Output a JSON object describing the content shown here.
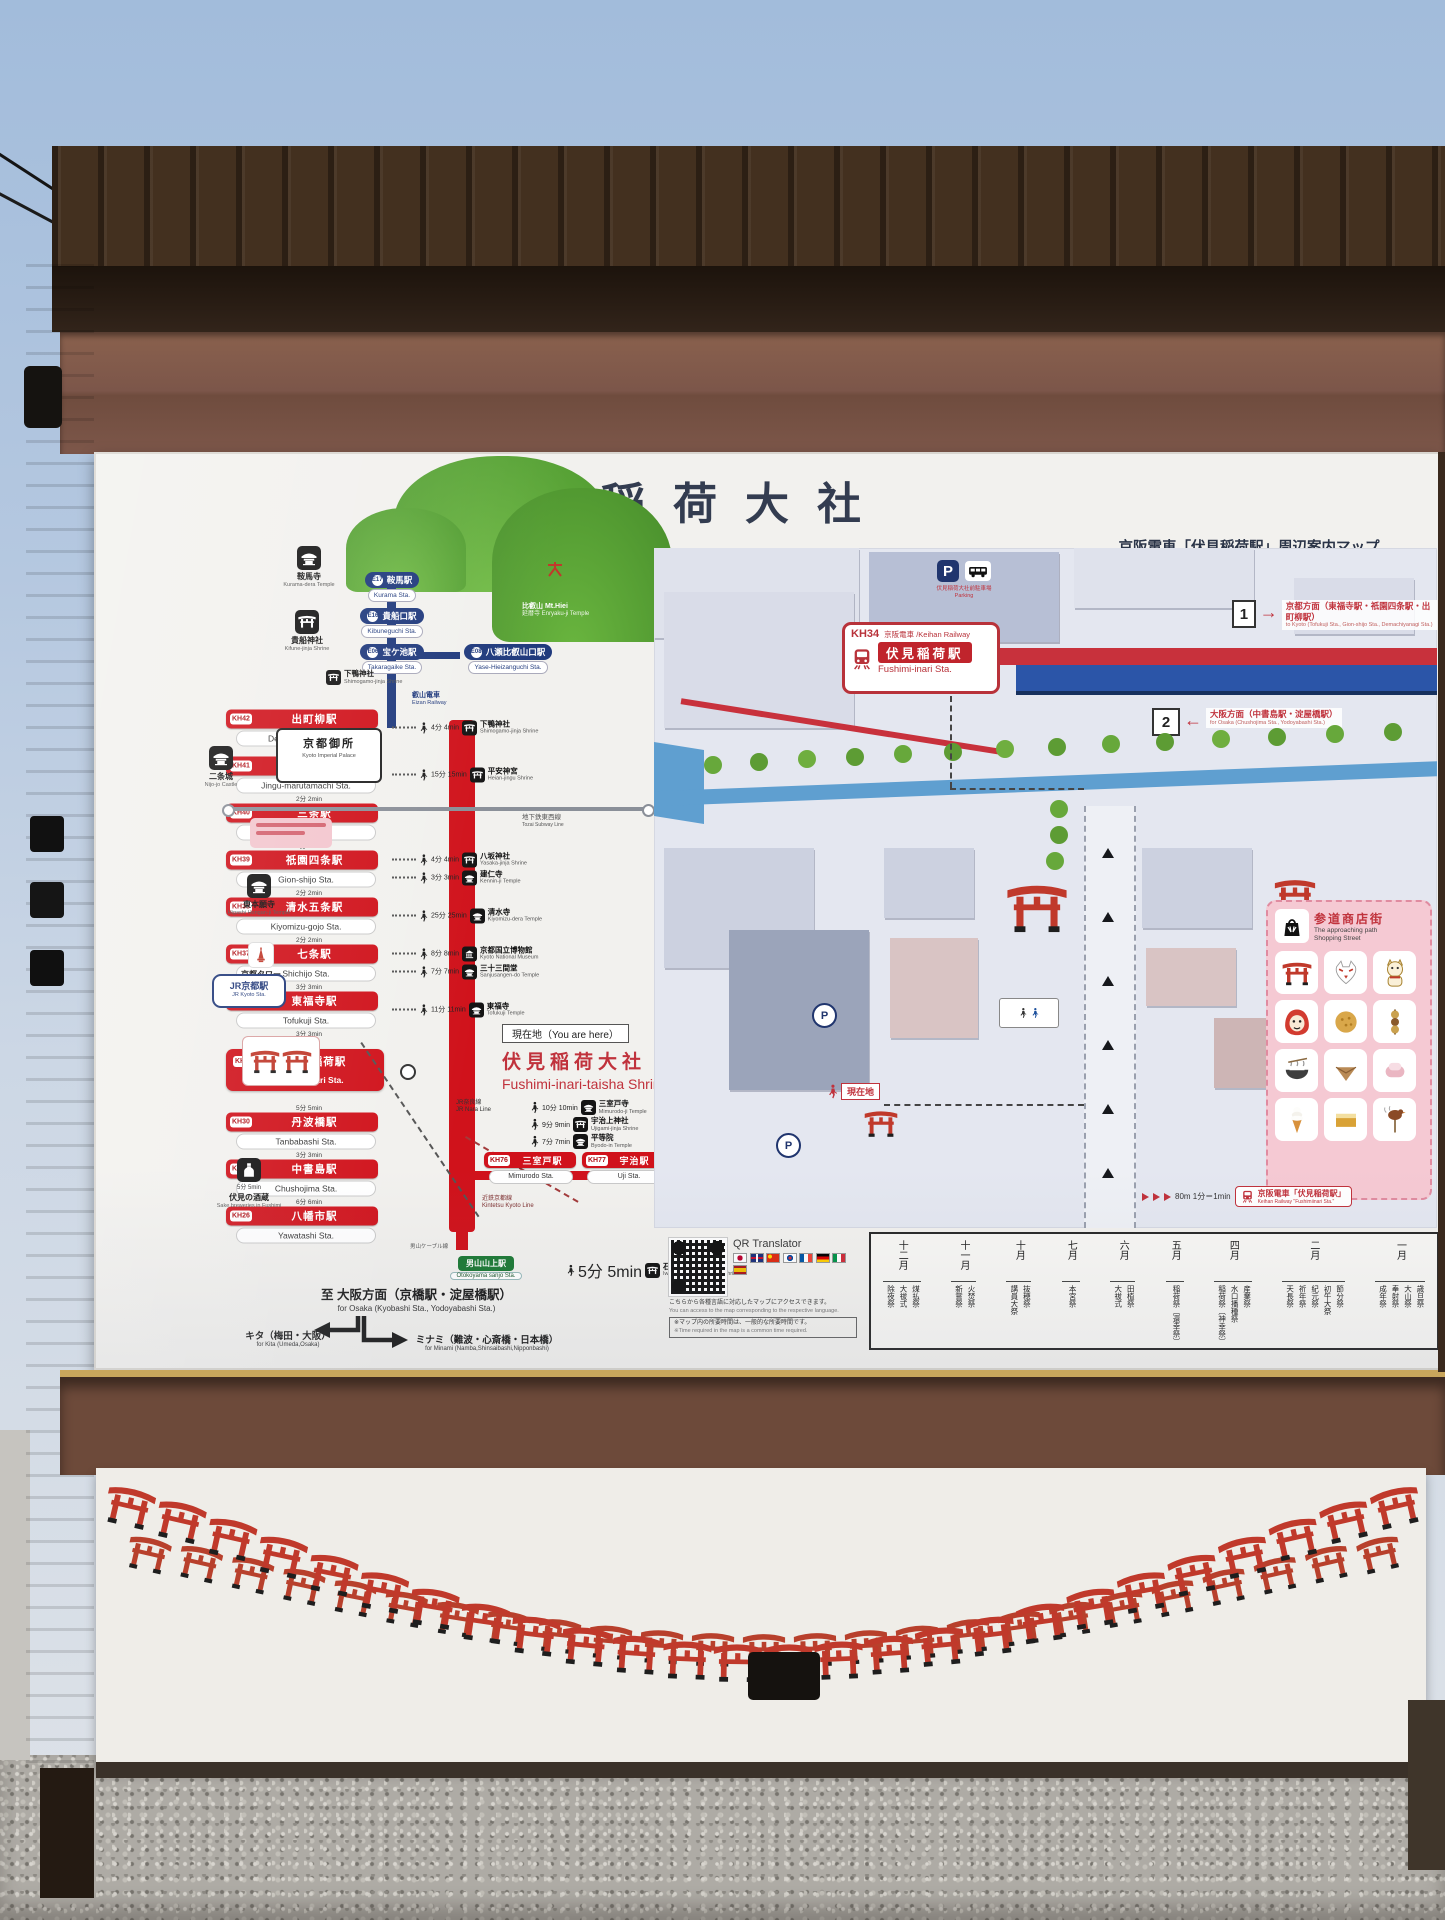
{
  "sign": {
    "title": "伏見稲荷大社"
  },
  "tourism": {
    "heading_ja": "京阪電車・観光マップ",
    "heading_en": "Keihan Railway / Tourism map",
    "eizan_label_ja": "叡山電車",
    "eizan_label_en": "Eizan Railway",
    "mt_ja": "比叡山 Mt.Hiei",
    "mt_temple": "延暦寺 Enryaku-ji Temple",
    "eizan_stations": [
      {
        "code": "E17",
        "ja": "鞍馬駅",
        "en": "Kurama Sta.",
        "pos": "e17"
      },
      {
        "code": "E16",
        "ja": "貴船口駅",
        "en": "Kibuneguchi Sta.",
        "pos": "e16"
      },
      {
        "code": "E06",
        "ja": "宝ケ池駅",
        "en": "Takaragaike Sta.",
        "pos": "e06"
      },
      {
        "code": "E08",
        "ja": "八瀬比叡山口駅",
        "en": "Yase-Hieizanguchi Sta.",
        "pos": "e08"
      }
    ],
    "stations": [
      {
        "code": "KH42",
        "ja": "出町柳駅",
        "en": "Demachiyanagi Sta.",
        "gap": "",
        "attractions": [
          {
            "t": "4分 4min",
            "icon": "#sym-torii",
            "ja": "下鴨神社",
            "en": "Shimogamo-jinja Shrine"
          }
        ]
      },
      {
        "code": "KH41",
        "ja": "神宮丸太町駅",
        "en": "Jingu-marutamachi Sta.",
        "gap": "3分 3min",
        "attractions": [
          {
            "t": "15分 15min",
            "icon": "#sym-torii",
            "ja": "平安神宮",
            "en": "Heian-jingu Shrine"
          }
        ]
      },
      {
        "code": "KH40",
        "ja": "三条駅",
        "en": "Sanjo Sta.",
        "gap": "2分 2min",
        "attractions": []
      },
      {
        "code": "KH39",
        "ja": "祇園四条駅",
        "en": "Gion-shijo Sta.",
        "gap": "2分 2min",
        "attractions": [
          {
            "t": "4分 4min",
            "icon": "#sym-torii",
            "ja": "八坂神社",
            "en": "Yasaka-jinja Shrine"
          },
          {
            "t": "3分 3min",
            "icon": "#sym-temple",
            "ja": "建仁寺",
            "en": "Kennin-ji Temple"
          }
        ]
      },
      {
        "code": "KH38",
        "ja": "清水五条駅",
        "en": "Kiyomizu-gojo Sta.",
        "gap": "2分 2min",
        "attractions": [
          {
            "t": "25分 25min",
            "icon": "#sym-temple",
            "ja": "清水寺",
            "en": "Kiyomizu-dera Temple"
          }
        ]
      },
      {
        "code": "KH37",
        "ja": "七条駅",
        "en": "Shichijo Sta.",
        "gap": "2分 2min",
        "attractions": [
          {
            "t": "8分 8min",
            "icon": "#sym-museum",
            "ja": "京都国立博物館",
            "en": "Kyoto National Museum"
          },
          {
            "t": "7分 7min",
            "icon": "#sym-temple",
            "ja": "三十三間堂",
            "en": "Sanjusangen-do Temple"
          }
        ]
      },
      {
        "code": "KH36",
        "ja": "東福寺駅",
        "en": "Tofukuji Sta.",
        "gap": "3分 3min",
        "attractions": [
          {
            "t": "11分 11min",
            "icon": "#sym-temple",
            "ja": "東福寺",
            "en": "Tofukuji Temple"
          }
        ]
      },
      {
        "code": "KH34",
        "ja": "伏見稲荷駅",
        "en": "Fushimi-Inari Sta.",
        "gap": "3分 3min",
        "cls": "hl",
        "attractions": []
      },
      {
        "code": "KH30",
        "ja": "丹波橋駅",
        "en": "Tanbabashi Sta.",
        "gap": "5分 5min",
        "attractions": []
      },
      {
        "code": "KH28",
        "ja": "中書島駅",
        "en": "Chushojima Sta.",
        "gap": "3分 3min",
        "attractions": []
      },
      {
        "code": "KH26",
        "ja": "八幡市駅",
        "en": "Yawatashi Sta.",
        "gap": "6分 6min",
        "attractions": []
      }
    ],
    "you_are_here": {
      "tag": "現在地（You are here）",
      "ja": "伏見稲荷大社",
      "en": "Fushimi-inari-taisha Shrine"
    },
    "uji": {
      "stations": [
        {
          "code": "KH76",
          "ja": "三室戸駅",
          "en": "Mimurodo Sta."
        },
        {
          "code": "KH77",
          "ja": "宇治駅",
          "en": "Uji Sta."
        }
      ],
      "attractions": [
        {
          "t": "10分 10min",
          "icon": "#sym-temple",
          "ja": "三室戸寺",
          "en": "Mimurodo-ji Temple"
        },
        {
          "t": "9分 9min",
          "icon": "#sym-torii",
          "ja": "宇治上神社",
          "en": "Ujigami-jinja Shrine"
        },
        {
          "t": "7分 7min",
          "icon": "#sym-temple",
          "ja": "平等院",
          "en": "Byodo-in Temple"
        }
      ]
    },
    "cable": {
      "line": "男山ケーブル線",
      "ja": "男山山上駅",
      "en": "Otokoyama sanjo Sta.",
      "t": "5分 5min",
      "dest_ja": "石清水八幡宮",
      "dest_en": "Iwashimizu-hachimangu Shrine"
    },
    "lines": {
      "subway_ja": "地下鉄東西線",
      "subway_en": "Tozai Subway Line",
      "jr_nara_ja": "JR奈良線",
      "jr_nara_en": "JR Nara Line",
      "kintetsu_ja": "近鉄京都線",
      "kintetsu_en": "Kintetsu Kyoto Line"
    },
    "landmarks": [
      {
        "pos": "lm-kurama",
        "icon": "#sym-temple",
        "ja": "鞍馬寺",
        "en": "Kurama-dera Temple",
        "t": ""
      },
      {
        "pos": "lm-kifune",
        "icon": "#sym-torii",
        "ja": "貴船神社",
        "en": "Kifune-jinja Shrine",
        "t": ""
      },
      {
        "pos": "lm-nijo",
        "icon": "#sym-temple",
        "ja": "二条城",
        "en": "Nijo-jo Castle",
        "t": ""
      },
      {
        "pos": "lm-honganji",
        "icon": "#sym-temple",
        "ja": "東本願寺",
        "en": "Higashi Hongan-ji Temple",
        "t": ""
      },
      {
        "pos": "lm-tower",
        "icon": "#sym-tower",
        "ja": "京都タワー",
        "en": "Kyoto Tower",
        "t": ""
      },
      {
        "pos": "lm-sake",
        "icon": "#sym-sake",
        "ja": "伏見の酒蔵",
        "en": "Sake breweries in Fushimi",
        "t": "5分 5min"
      }
    ],
    "shimogamo_ja": "下鴨神社",
    "shimogamo_en": "Shimogamo-jinja Shrine",
    "palace": {
      "ja": "京都御所",
      "en": "Kyoto Imperial Palace"
    },
    "jr_kyoto": {
      "ja": "JR京都駅",
      "en": "JR Kyoto Sta."
    },
    "osaka": {
      "ja": "至 大阪方面（京橋駅・淀屋橋駅）",
      "en": "for Osaka (Kyobashi Sta., Yodoyabashi Sta.)"
    },
    "kita": {
      "ja": "キタ（梅田・大阪）",
      "en": "for Kita (Umeda,Osaka)"
    },
    "minami": {
      "ja": "ミナミ（難波・心斎橋・日本橋）",
      "en": "for Minami (Namba,Shinsaibashi,Nipponbashi)"
    },
    "qr": {
      "label": "QR Translator",
      "note_ja": "こちらから各種言語に対応したマップにアクセスできます。",
      "note_en": "You can access to the map corresponding to the respective language.",
      "disc_ja": "※マップ内の所要時間は、一般的な所要時間です。",
      "disc_en": "※Time required in the map is a common time required.",
      "flags": [
        "jp",
        "gb",
        "cn",
        "kr",
        "fr",
        "de",
        "it",
        "es"
      ]
    }
  },
  "guidance": {
    "heading_ja": "京阪電車「伏見稲荷駅」周辺案内マップ",
    "heading_en": "Keihan Railway \"Fushimi-inari Sta.\" around guidance map",
    "sign": {
      "code": "KH34",
      "co": "京阪電車 /Keihan Railway",
      "ja": "伏見稲荷駅",
      "en": "Fushimi-inari Sta."
    },
    "parking": {
      "p": "P",
      "ja": "伏見稲荷大社前駐車場",
      "en": "Parking"
    },
    "dir1": {
      "n": "1",
      "arrow": "→",
      "ja": "京都方面（東福寺駅・祇園四条駅・出町柳駅）",
      "en": "to Kyoto (Tofukuji Sta., Gion-shijo Sta., Demachiyanagi Sta.)"
    },
    "dir2": {
      "n": "2",
      "arrow": "←",
      "ja": "大阪方面（中書島駅・淀屋橋駅）",
      "en": "for Osaka (Chushojima Sta., Yodoyabashi Sta.)"
    },
    "here": "現在地",
    "p_mark": "P",
    "legend": {
      "ja": "参道商店街",
      "en1": "The approaching path",
      "en2": "Shopping Street",
      "items": [
        {
          "icon": "#sym-torii",
          "name": "mini-torii"
        },
        {
          "icon": "#sym-fox",
          "name": "fox-mask"
        },
        {
          "icon": "#sym-cat",
          "name": "lucky-cat"
        },
        {
          "icon": "#sym-daruma",
          "name": "daruma"
        },
        {
          "icon": "#sym-senbei",
          "name": "senbei"
        },
        {
          "icon": "#sym-dango",
          "name": "kushi-dango"
        },
        {
          "icon": "#sym-bowl",
          "name": "noodle-bowl"
        },
        {
          "icon": "#sym-sweet",
          "name": "yatsuhashi"
        },
        {
          "icon": "#sym-mochi",
          "name": "mochi"
        },
        {
          "icon": "#sym-soft",
          "name": "soft-ice-cream"
        },
        {
          "icon": "#sym-castella",
          "name": "baked-sweets"
        },
        {
          "icon": "#sym-bird",
          "name": "grilled-sparrow"
        }
      ]
    },
    "scale": {
      "walk": "80m 1分＝1min",
      "tag_ja": "京阪電車「伏見稲荷駅」",
      "tag_en": "Keihan Railway \"Fushimiinari Sta.\""
    },
    "calendar": {
      "title": "伏見稲荷大社",
      "months": [
        {
          "m": "一月",
          "f": [
            "歳旦祭",
            "大山祭",
            "奉射祭",
            "成年祭"
          ]
        },
        {
          "m": "二月",
          "f": [
            "節分祭",
            "初午大祭",
            "紀元祭",
            "祈年祭",
            "天長祭"
          ]
        },
        {
          "m": "四月",
          "f": [
            "産業祭",
            "水口播種祭",
            "稲荷祭〔神幸祭〕"
          ]
        },
        {
          "m": "五月",
          "f": [
            "稲荷祭〔還幸祭〕"
          ]
        },
        {
          "m": "六月",
          "f": [
            "田植祭",
            "大祓式"
          ]
        },
        {
          "m": "七月",
          "f": [
            "本宮祭"
          ]
        },
        {
          "m": "十月",
          "f": [
            "抜穂祭",
            "講員大祭"
          ]
        },
        {
          "m": "十一月",
          "f": [
            "火焚祭",
            "新嘗祭"
          ]
        },
        {
          "m": "十二月",
          "f": [
            "煤払祭",
            "大祓式",
            "除夜祭"
          ]
        }
      ]
    }
  }
}
